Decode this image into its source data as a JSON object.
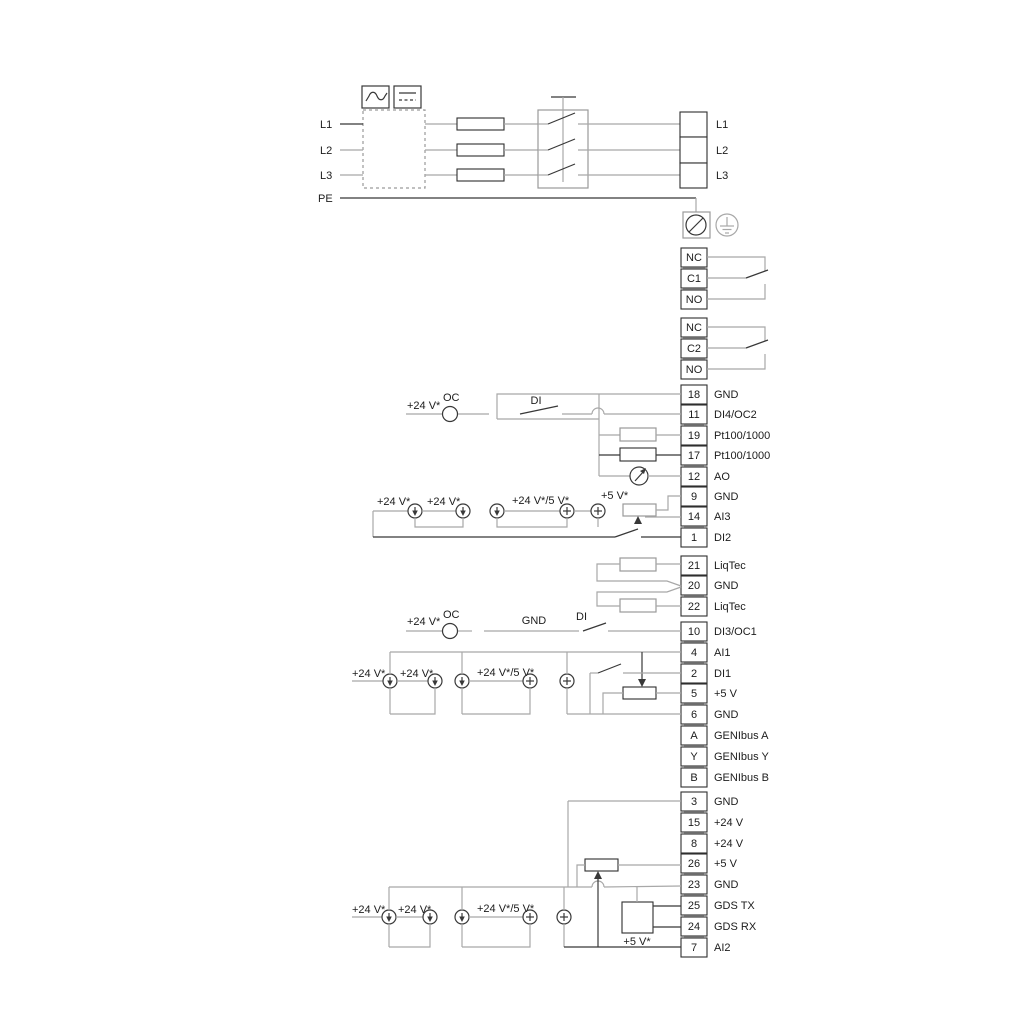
{
  "colors": {
    "wire_gray": "#a8a8a8",
    "wire_dark": "#383838",
    "text": "#1c1c1c",
    "strip": "#b9b9b9",
    "background": "#ffffff"
  },
  "power": {
    "in": [
      "L1",
      "L2",
      "L3",
      "PE"
    ],
    "out": [
      "L1",
      "L2",
      "L3"
    ]
  },
  "relays": [
    [
      "NC",
      "C1",
      "NO"
    ],
    [
      "NC",
      "C2",
      "NO"
    ]
  ],
  "ann": {
    "v24": "+24 V*",
    "v245": "+24 V*/5 V*",
    "v5": "+5 V*",
    "oc": "OC",
    "di": "DI",
    "gnd": "GND"
  },
  "terminals": {
    "g1": [
      [
        "18",
        "GND"
      ],
      [
        "11",
        "DI4/OC2"
      ],
      [
        "19",
        "Pt100/1000"
      ],
      [
        "17",
        "Pt100/1000"
      ],
      [
        "12",
        "AO"
      ],
      [
        "9",
        "GND"
      ],
      [
        "14",
        "AI3"
      ],
      [
        "1",
        "DI2"
      ]
    ],
    "g2": [
      [
        "21",
        "LiqTec"
      ],
      [
        "20",
        "GND"
      ],
      [
        "22",
        "LiqTec"
      ]
    ],
    "g3": [
      [
        "10",
        "DI3/OC1"
      ],
      [
        "4",
        "AI1"
      ],
      [
        "2",
        "DI1"
      ],
      [
        "5",
        "+5 V"
      ],
      [
        "6",
        "GND"
      ],
      [
        "A",
        "GENIbus A"
      ],
      [
        "Y",
        "GENIbus Y"
      ],
      [
        "B",
        "GENIbus B"
      ]
    ],
    "g4": [
      [
        "3",
        "GND"
      ],
      [
        "15",
        "+24 V"
      ],
      [
        "8",
        "+24 V"
      ],
      [
        "26",
        "+5 V"
      ],
      [
        "23",
        "GND"
      ],
      [
        "25",
        "GDS TX"
      ],
      [
        "24",
        "GDS RX"
      ],
      [
        "7",
        "AI2"
      ]
    ]
  }
}
